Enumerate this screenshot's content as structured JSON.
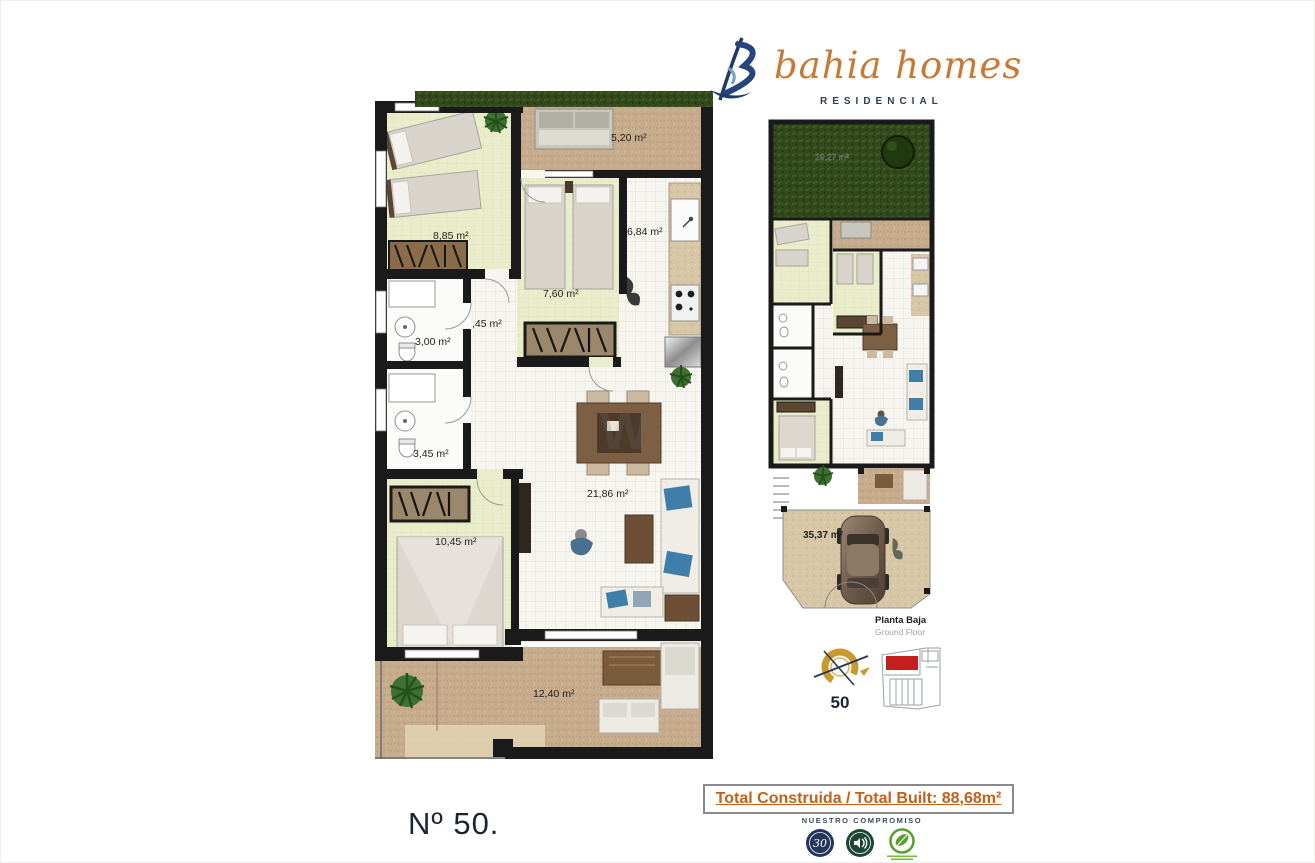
{
  "brand": {
    "name": "bahia homes",
    "tagline": "RESIDENCIAL"
  },
  "page": {
    "unit_label": "Nº 50.",
    "watermark": "W"
  },
  "main_plan": {
    "labels": {
      "terrace_top": "5,20 m²",
      "bedroom1": "8,85 m²",
      "bedroom2": "7,60 m²",
      "kitchen": "6,84 m²",
      "bathroom1": "3,00 m²",
      "hall": ",45 m²",
      "bathroom2": "3,45 m²",
      "master_bedroom": "10,45 m²",
      "living_room": "21,86 m²",
      "terrace_bottom": "12,40 m²"
    }
  },
  "site_plan": {
    "labels": {
      "garden": "29,27 m²",
      "driveway": "35,37 m²"
    },
    "caption_es": "Planta Baja",
    "caption_en": "Ground Floor",
    "orientation_number": "50"
  },
  "totals": {
    "text": "Total Construida / Total Built: 88,68m²"
  },
  "commitment": {
    "title": "NUESTRO COMPROMISO",
    "badge_30": "30",
    "badges": [
      "30-anniversary-badge",
      "acoustic-quality-badge",
      "sustainability-leaf-badge"
    ]
  },
  "colors": {
    "brand_orange": "#c87a35",
    "brand_navy": "#27415f",
    "wall_black": "#1a1a1a",
    "bedroom_floor": "#e9edcb",
    "tile_floor": "#f6f5ef",
    "terrace_sand": "#c6ac8c",
    "grass_green": "#31491d",
    "sofa_blue": "#3f7ea8",
    "total_orange": "#c2611c",
    "compass_gold": "#c8992c",
    "site_highlight_red": "#c41e1e",
    "badge_navy": "#24365c",
    "badge_green": "#1c4734",
    "eco_green": "#5aa02e"
  }
}
